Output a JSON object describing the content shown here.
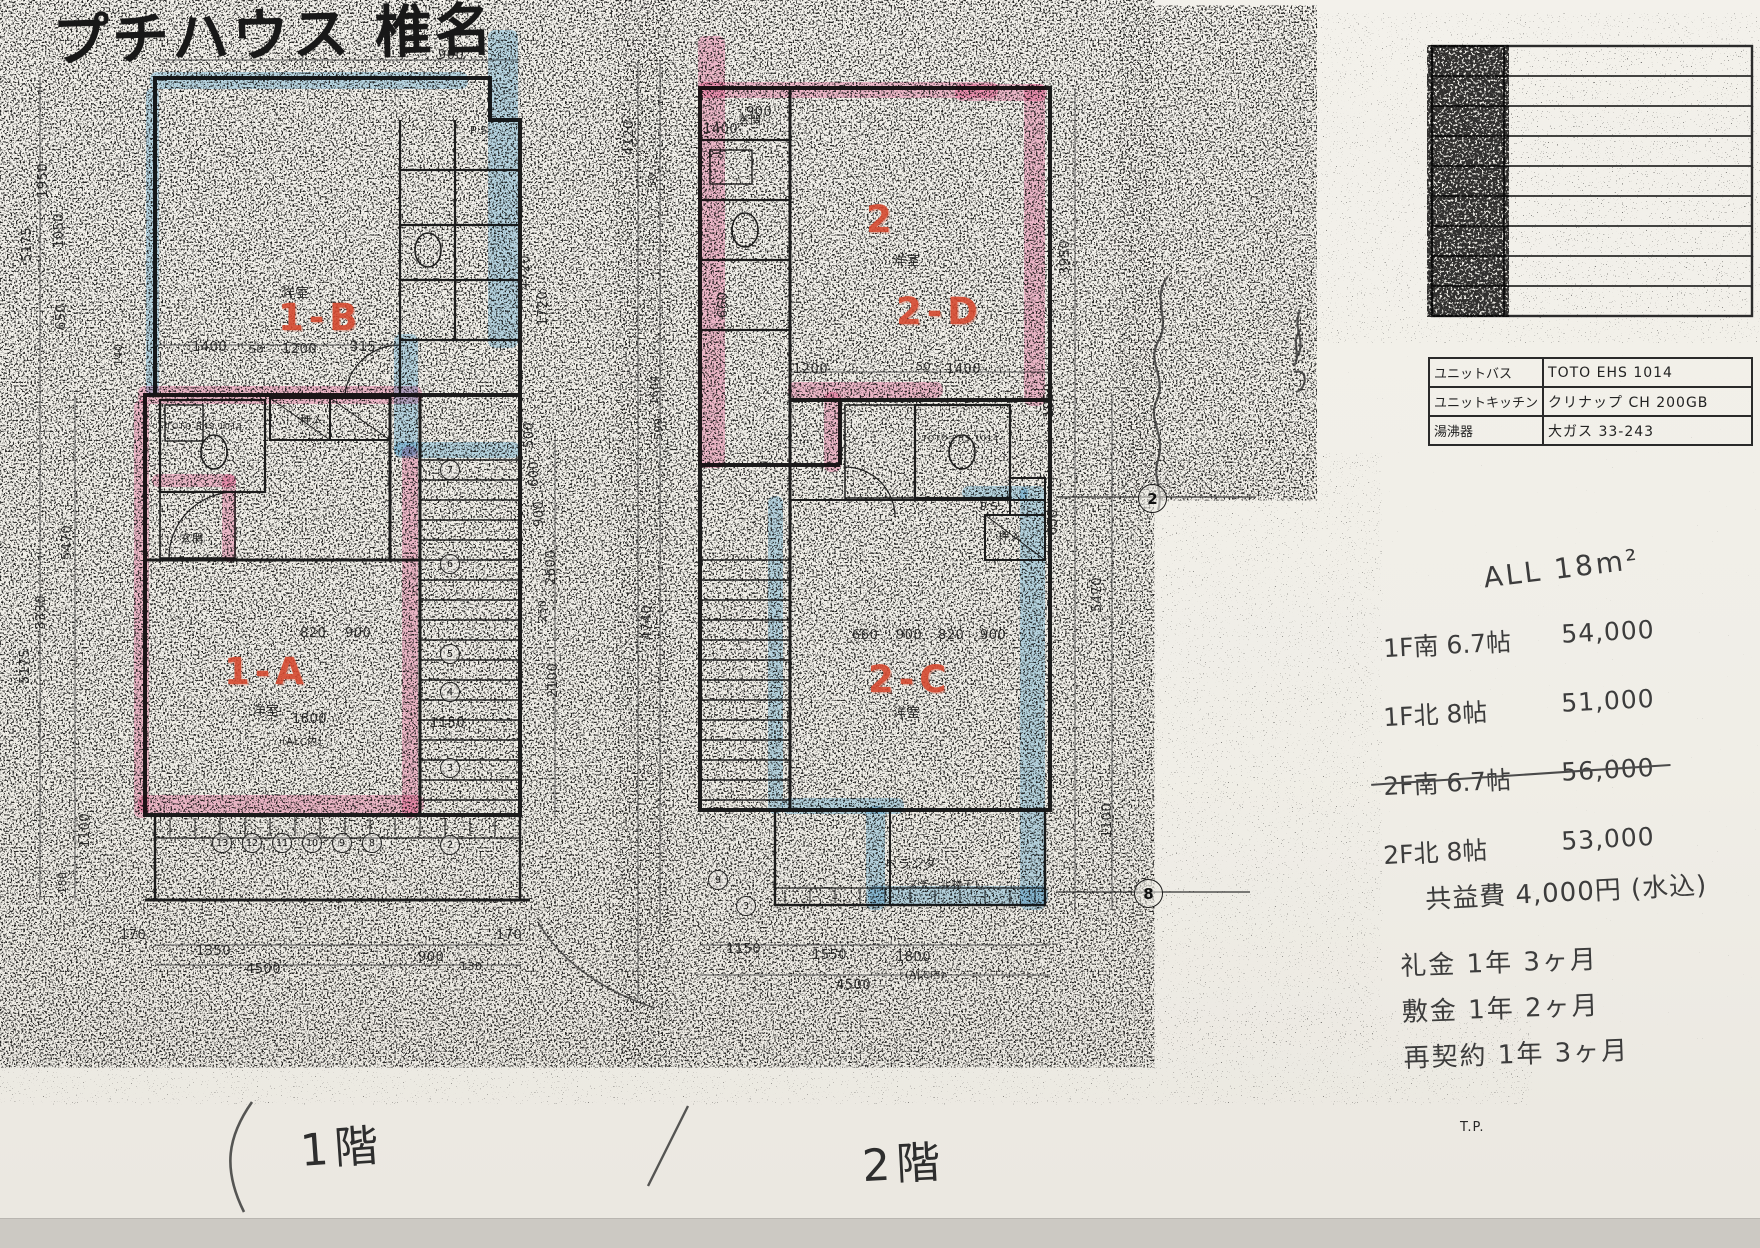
{
  "document": {
    "title": "プチハウス 椎名",
    "floor1_label": "1階",
    "floor2_label": "2階"
  },
  "notes": {
    "area": "ALL 18m²",
    "rents": [
      {
        "room": "1F南 6.7帖",
        "price": "54,000",
        "struck": false
      },
      {
        "room": "1F北 8帖",
        "price": "51,000",
        "struck": false
      },
      {
        "room": "2F南 6.7帖",
        "price": "56,000",
        "struck": true
      },
      {
        "room": "2F北 8帖",
        "price": "53,000",
        "struck": false
      }
    ],
    "common_fee": "共益費 4,000円 (水込)",
    "terms": [
      "礼金 1年 3ヶ月",
      "敷金 1年 2ヶ月",
      "再契約 1年 3ヶ月"
    ]
  },
  "equipment_table": {
    "rows": [
      {
        "label": "ユニットバス",
        "value": "TOTO EHS 1014"
      },
      {
        "label": "ユニットキッチン",
        "value": "クリナップ CH 200GB"
      },
      {
        "label": "湯沸器",
        "value": "大ガス 33-243"
      }
    ]
  },
  "colors": {
    "highlight_pink": "#f48ab8",
    "highlight_blue": "#7fc2e8",
    "red_marker": "#d5492f"
  },
  "annotations": [
    {
      "t": "1-B",
      "x": 278,
      "y": 296,
      "k": "red",
      "n": "unit-label-1b"
    },
    {
      "t": "1-A",
      "x": 224,
      "y": 650,
      "k": "red",
      "n": "unit-label-1a"
    },
    {
      "t": "2",
      "x": 866,
      "y": 198,
      "k": "red",
      "n": "floor2-number"
    },
    {
      "t": "2-D",
      "x": 896,
      "y": 290,
      "k": "red",
      "n": "unit-label-2d"
    },
    {
      "t": "2-C",
      "x": 868,
      "y": 658,
      "k": "red",
      "n": "unit-label-2c"
    },
    {
      "t": "洋室",
      "x": 282,
      "y": 282,
      "k": "room"
    },
    {
      "t": "洋室",
      "x": 252,
      "y": 700,
      "k": "room"
    },
    {
      "t": "洋室",
      "x": 893,
      "y": 250,
      "k": "room"
    },
    {
      "t": "洋室",
      "x": 893,
      "y": 702,
      "k": "room"
    },
    {
      "t": "押入",
      "x": 300,
      "y": 412,
      "k": "room",
      "s": 11
    },
    {
      "t": "押入",
      "x": 998,
      "y": 528,
      "k": "room",
      "s": 11
    },
    {
      "t": "玄関",
      "x": 180,
      "y": 530,
      "k": "room",
      "s": 11
    },
    {
      "t": "玄関",
      "x": 738,
      "y": 112,
      "k": "room",
      "s": 11
    },
    {
      "t": "P.S.",
      "x": 470,
      "y": 124,
      "k": "room",
      "s": 11
    },
    {
      "t": "P.S.",
      "x": 708,
      "y": 150,
      "k": "room",
      "s": 10
    },
    {
      "t": "P.S.",
      "x": 980,
      "y": 500,
      "k": "room",
      "s": 11
    },
    {
      "t": "ベランダ",
      "x": 885,
      "y": 855,
      "k": "room",
      "s": 12
    },
    {
      "t": "スチール物干し",
      "x": 908,
      "y": 876,
      "k": "room",
      "s": 10
    },
    {
      "t": "TOTO EHS 1014",
      "x": 166,
      "y": 422,
      "k": "room",
      "s": 8
    },
    {
      "t": "TOTO EHS 1014",
      "x": 922,
      "y": 434,
      "k": "room",
      "s": 8
    },
    {
      "t": "T.P.",
      "x": 1460,
      "y": 1120,
      "k": "room",
      "s": 13,
      "n": "tp-note"
    },
    {
      "t": "900",
      "x": 438,
      "y": 48
    },
    {
      "t": "1950",
      "x": 36,
      "y": 198,
      "r": -90
    },
    {
      "t": "1050",
      "x": 52,
      "y": 248,
      "r": -90
    },
    {
      "t": "5175",
      "x": 20,
      "y": 262,
      "r": -90
    },
    {
      "t": "650",
      "x": 54,
      "y": 330,
      "r": -90
    },
    {
      "t": "1400",
      "x": 192,
      "y": 340
    },
    {
      "t": "50",
      "x": 249,
      "y": 343,
      "s": 11
    },
    {
      "t": "1200",
      "x": 282,
      "y": 342
    },
    {
      "t": "315",
      "x": 350,
      "y": 340
    },
    {
      "t": "140",
      "x": 112,
      "y": 366,
      "r": -90,
      "s": 11
    },
    {
      "t": "4720",
      "x": 518,
      "y": 290,
      "r": -90
    },
    {
      "t": "1720",
      "x": 536,
      "y": 326,
      "r": -90
    },
    {
      "t": "4120",
      "x": 622,
      "y": 155,
      "r": -90
    },
    {
      "t": "50",
      "x": 646,
      "y": 188,
      "r": -90,
      "s": 11
    },
    {
      "t": "500",
      "x": 522,
      "y": 448,
      "r": -90
    },
    {
      "t": "600",
      "x": 527,
      "y": 487,
      "r": -90
    },
    {
      "t": "900",
      "x": 532,
      "y": 527,
      "r": -90
    },
    {
      "t": "2600",
      "x": 544,
      "y": 585,
      "r": -90
    },
    {
      "t": "250",
      "x": 536,
      "y": 622,
      "r": -90,
      "s": 11
    },
    {
      "t": "2100",
      "x": 546,
      "y": 698,
      "r": -90
    },
    {
      "t": "5470",
      "x": 60,
      "y": 560,
      "r": -90
    },
    {
      "t": "3330",
      "x": 34,
      "y": 630,
      "r": -90
    },
    {
      "t": "5175",
      "x": 18,
      "y": 684,
      "r": -90
    },
    {
      "t": "1100",
      "x": 78,
      "y": 848,
      "r": -90
    },
    {
      "t": "180",
      "x": 56,
      "y": 894,
      "r": -90,
      "s": 11
    },
    {
      "t": "820",
      "x": 300,
      "y": 626
    },
    {
      "t": "900",
      "x": 345,
      "y": 626
    },
    {
      "t": "1800",
      "x": 292,
      "y": 712
    },
    {
      "t": "1150",
      "x": 430,
      "y": 716
    },
    {
      "t": "(ALC内)",
      "x": 282,
      "y": 733,
      "s": 10
    },
    {
      "t": "170",
      "x": 120,
      "y": 928
    },
    {
      "t": "1350",
      "x": 196,
      "y": 944
    },
    {
      "t": "4500",
      "x": 246,
      "y": 962
    },
    {
      "t": "900",
      "x": 418,
      "y": 950
    },
    {
      "t": "130",
      "x": 460,
      "y": 960,
      "s": 11
    },
    {
      "t": "170",
      "x": 496,
      "y": 928
    },
    {
      "t": "1400",
      "x": 703,
      "y": 122
    },
    {
      "t": "900",
      "x": 746,
      "y": 105
    },
    {
      "t": "660",
      "x": 716,
      "y": 318,
      "r": -90
    },
    {
      "t": "1200",
      "x": 793,
      "y": 362
    },
    {
      "t": "50",
      "x": 916,
      "y": 360,
      "s": 11
    },
    {
      "t": "1400",
      "x": 946,
      "y": 362
    },
    {
      "t": "3950",
      "x": 1058,
      "y": 275,
      "r": -90
    },
    {
      "t": "1050",
      "x": 1042,
      "y": 418,
      "r": -90
    },
    {
      "t": "650",
      "x": 1046,
      "y": 535,
      "r": -90
    },
    {
      "t": "5470",
      "x": 1090,
      "y": 612,
      "r": -90
    },
    {
      "t": "660",
      "x": 852,
      "y": 628
    },
    {
      "t": "900",
      "x": 896,
      "y": 628
    },
    {
      "t": "820",
      "x": 938,
      "y": 628
    },
    {
      "t": "900",
      "x": 980,
      "y": 628
    },
    {
      "t": "4740",
      "x": 640,
      "y": 640,
      "r": -90
    },
    {
      "t": "1604",
      "x": 648,
      "y": 405,
      "r": -90,
      "s": 11
    },
    {
      "t": "599",
      "x": 652,
      "y": 440,
      "r": -90,
      "s": 11
    },
    {
      "t": "1100",
      "x": 1100,
      "y": 838,
      "r": -90
    },
    {
      "t": "1150",
      "x": 726,
      "y": 942
    },
    {
      "t": "1550",
      "x": 812,
      "y": 948
    },
    {
      "t": "1800",
      "x": 896,
      "y": 950
    },
    {
      "t": "4500",
      "x": 836,
      "y": 978
    },
    {
      "t": "(ALC内)",
      "x": 905,
      "y": 966,
      "s": 10
    },
    {
      "t": "13",
      "x": 212,
      "y": 833,
      "k": "circ"
    },
    {
      "t": "12",
      "x": 242,
      "y": 833,
      "k": "circ"
    },
    {
      "t": "11",
      "x": 272,
      "y": 833,
      "k": "circ"
    },
    {
      "t": "10",
      "x": 302,
      "y": 833,
      "k": "circ"
    },
    {
      "t": "9",
      "x": 332,
      "y": 833,
      "k": "circ"
    },
    {
      "t": "8",
      "x": 362,
      "y": 833,
      "k": "circ"
    },
    {
      "t": "7",
      "x": 440,
      "y": 460,
      "k": "circ"
    },
    {
      "t": "6",
      "x": 440,
      "y": 554,
      "k": "circ"
    },
    {
      "t": "5",
      "x": 440,
      "y": 644,
      "k": "circ"
    },
    {
      "t": "4",
      "x": 440,
      "y": 682,
      "k": "circ"
    },
    {
      "t": "3",
      "x": 440,
      "y": 758,
      "k": "circ"
    },
    {
      "t": "2",
      "x": 440,
      "y": 835,
      "k": "circ"
    },
    {
      "t": "9",
      "x": 708,
      "y": 870,
      "k": "circ"
    },
    {
      "t": "3",
      "x": 736,
      "y": 896,
      "k": "circ"
    },
    {
      "t": "2",
      "x": 1138,
      "y": 484,
      "k": "circlg",
      "n": "grid-marker-2"
    },
    {
      "t": "8",
      "x": 1134,
      "y": 879,
      "k": "circlg",
      "n": "grid-marker-8"
    }
  ]
}
